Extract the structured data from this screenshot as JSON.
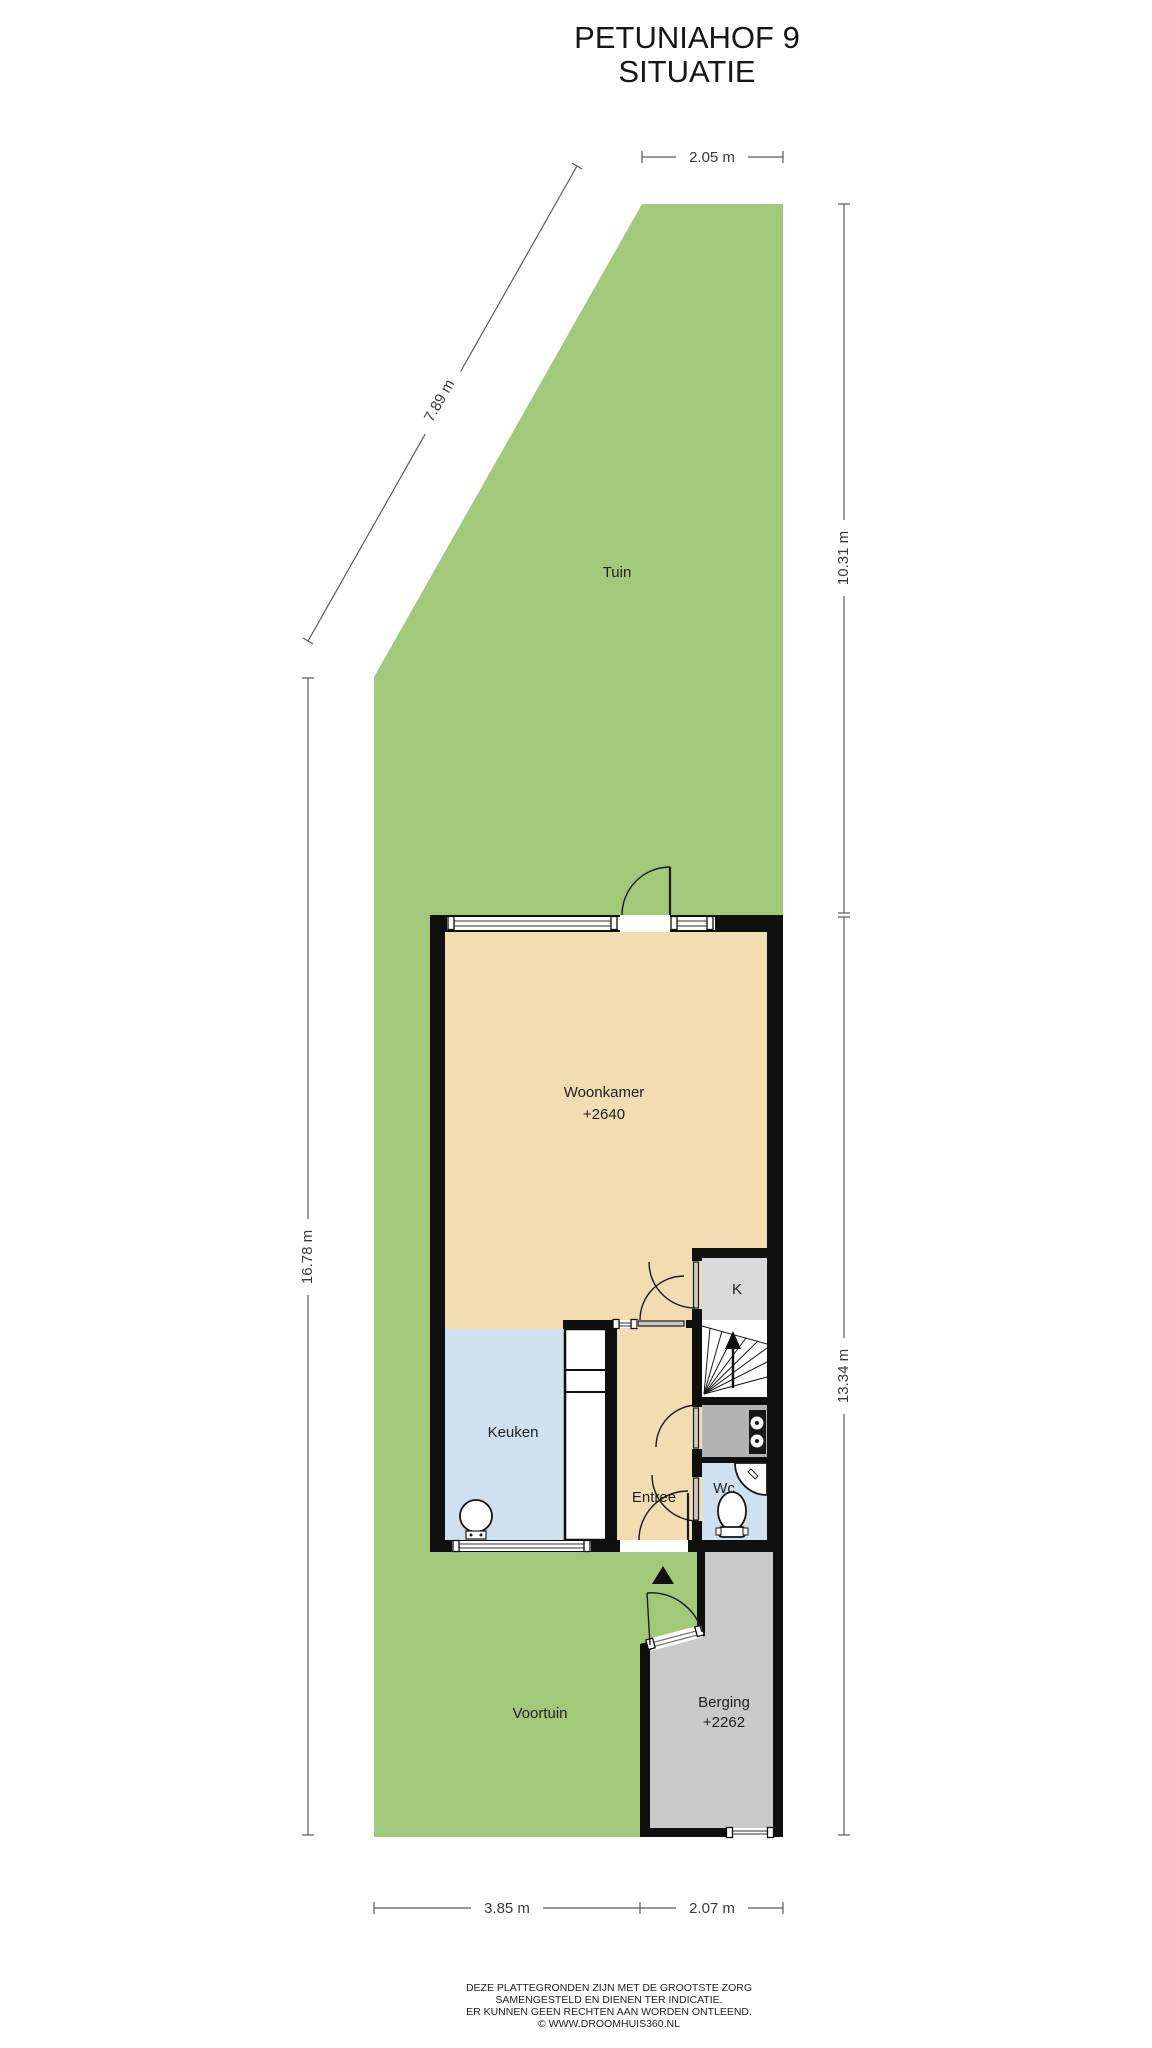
{
  "title": {
    "line1": "PETUNIAHOF 9",
    "line2": "SITUATIE"
  },
  "dimensions": {
    "top_width": "2.05 m",
    "diagonal_left": "7.89 m",
    "right_upper": "10.31 m",
    "left_side": "16.78 m",
    "right_lower": "13.34 m",
    "bottom_left": "3.85 m",
    "bottom_right": "2.07 m"
  },
  "rooms": {
    "tuin": {
      "label": "Tuin"
    },
    "woonkamer": {
      "label": "Woonkamer",
      "elevation": "+2640"
    },
    "kast": {
      "label": "K"
    },
    "keuken": {
      "label": "Keuken"
    },
    "entree": {
      "label": "Entree"
    },
    "wc": {
      "label": "Wc"
    },
    "berging": {
      "label": "Berging",
      "elevation": "+2262"
    },
    "voortuin": {
      "label": "Voortuin"
    }
  },
  "footer": {
    "line1": "DEZE PLATTEGRONDEN ZIJN MET DE GROOTSTE ZORG",
    "line2": "SAMENGESTELD EN DIENEN TER INDICATIE.",
    "line3": "ER KUNNEN GEEN RECHTEN AAN WORDEN ONTLEEND.",
    "line4": "© WWW.DROOMHUIS360.NL"
  },
  "colors": {
    "garden_green": "#a2c87a",
    "floor_beige": "#f2dcb2",
    "kitchen_wc_blue": "#cfe1f1",
    "closet_gray": "#d9d9d9",
    "meter_cupboard_gray": "#b3b3b3",
    "storage_gray": "#c9c9c9",
    "wall_black": "#0f0f0f",
    "dimension_gray": "#5a5a5a"
  }
}
